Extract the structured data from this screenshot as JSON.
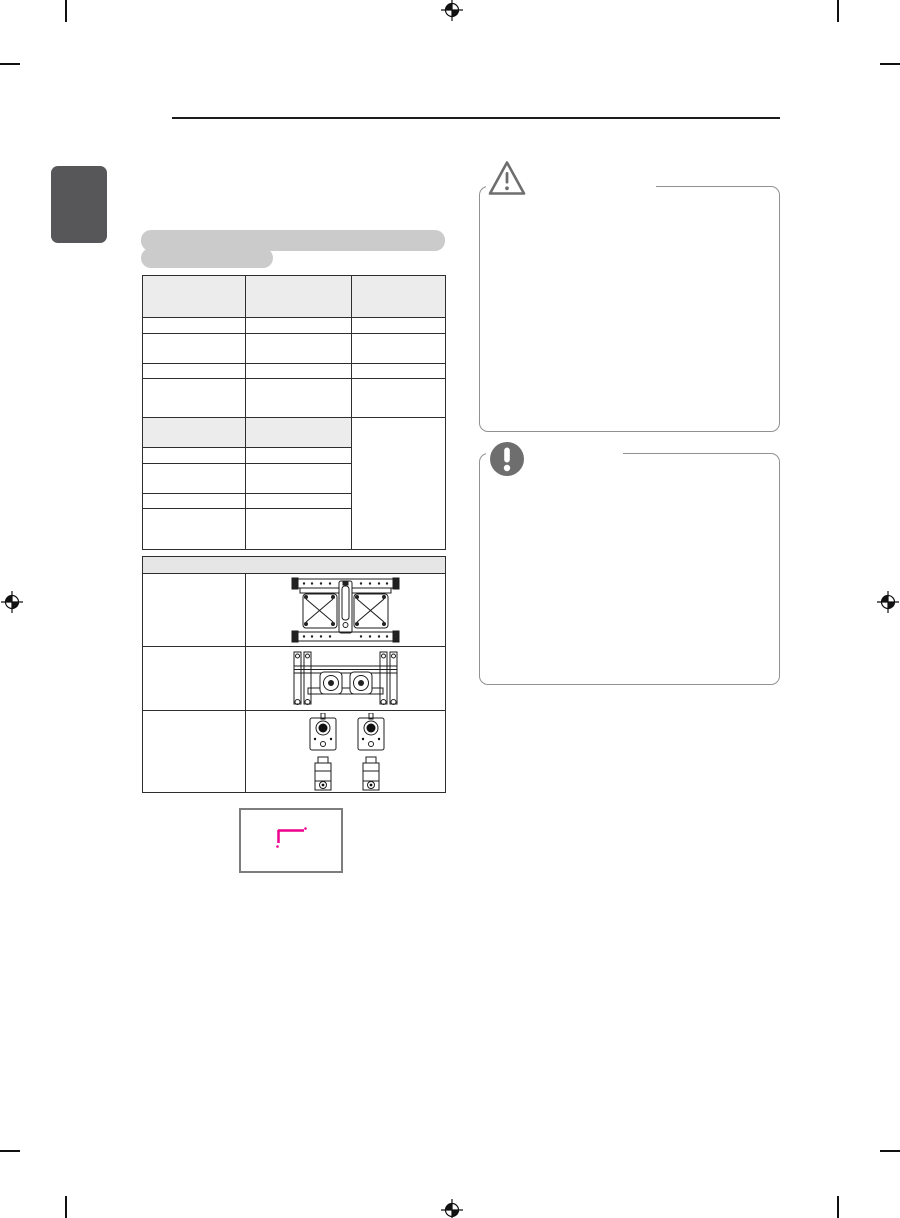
{
  "page": {
    "background": "#ffffff",
    "width_px": 900,
    "height_px": 1218,
    "kind": "scanned-manual-page"
  },
  "print_marks": {
    "color": "#111111",
    "registration_icon": "registration-crosshair-icon",
    "registration_positions": [
      "top-center",
      "middle-left",
      "middle-right",
      "bottom-center"
    ],
    "crop_tick_positions": [
      "top-left",
      "top-right",
      "bottom-left",
      "bottom-right"
    ],
    "edge_dash_positions": [
      "top-left",
      "top-right",
      "bottom-left",
      "bottom-right"
    ]
  },
  "header": {
    "rule_color": "#1c1c1c"
  },
  "chapter_tab": {
    "fill": "#57575a"
  },
  "section_heading_placeholder": {
    "fill": "#cbcbcb",
    "line_count": 2
  },
  "spec_table": {
    "border_color": "#2e2e2e",
    "header_fill": "#ececec",
    "columns": 3,
    "top_header_cells": [
      "",
      "",
      ""
    ],
    "upper_body_rows": 4,
    "sub_header_cells": [
      "",
      ""
    ],
    "lower_body_rows": 4,
    "third_column_merged": true,
    "cells_empty": true
  },
  "figure_table": {
    "border_color": "#2e2e2e",
    "header_fill": "#e6e6e6",
    "header_cells_empty": true,
    "rows": [
      {
        "figure": "wall-mount-bracket-top-view"
      },
      {
        "figure": "wall-mount-bracket-front-view"
      },
      {
        "figure": "mount-plates-and-spacers"
      }
    ]
  },
  "dimension_box": {
    "border_color": "#7d7d7d",
    "mark": "corner-dimension-lines",
    "mark_color": "#ec008c"
  },
  "caution_panel": {
    "icon": "warning-triangle-icon",
    "icon_color": "#6e6e6e",
    "border_color": "#919191",
    "title_text": "",
    "body_text": ""
  },
  "note_panel": {
    "icon": "exclamation-circle-icon",
    "icon_color": "#6e6e6e",
    "border_color": "#919191",
    "title_text": "",
    "body_text": ""
  }
}
